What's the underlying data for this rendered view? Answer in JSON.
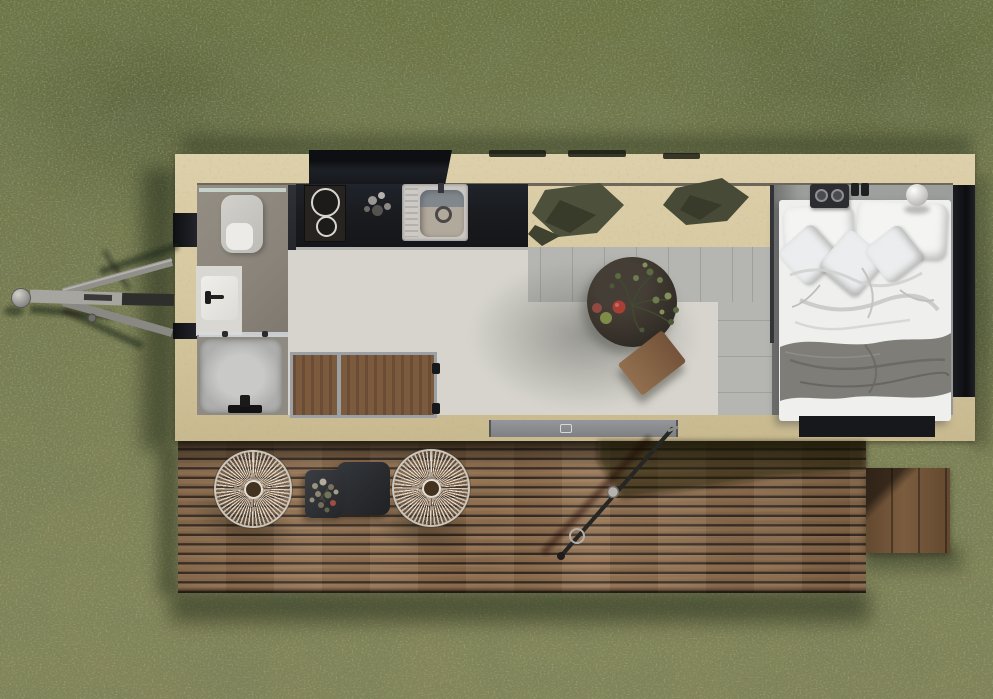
{
  "meta": {
    "description": "Aerial top-down 3D render of a tiny house on wheels standing on a grass lawn, with an attached hardwood terrace deck, tow hitch on the left and a small wooden step platform on the right",
    "view": "top-down aerial",
    "lighting": "daylight, sun from lower-left casting shadows up-right and down-left"
  },
  "palette": {
    "grass_base": "#76794f",
    "wood_frame": "#d6c8a0",
    "roof_black": "#15171b",
    "counter_black": "#1a1c20",
    "bath_floor": "#8a847b",
    "shower_tray": "#aeafad",
    "tile_gray": "#b5b6b2",
    "rug_light": "#d6d4cd",
    "bedroom_floor": "#a1a3a1",
    "bed_white": "#efefed",
    "blanket_gray": "#7f7d78",
    "table_dark": "#332d27",
    "stool_wood": "#8a6747",
    "deck_plank": "#9c7859",
    "deck_gap": "#33271d",
    "step_wood": "#7b5c3e",
    "chair_wicker": "#e8e4dc",
    "cushion_olive_a": "#4d503b",
    "cushion_olive_b": "#474a36",
    "cushion_fold": "#383b2a",
    "metal_gray": "#9a9894",
    "sill_gray": "#8f9196",
    "plant_green": "#5c6a42",
    "apple_red": "#a83e34",
    "apple_green": "#7e8c48"
  },
  "house": {
    "structure": [
      "light timber perimeter frame",
      "black roof opening above kitchen",
      "three dark roof vents along top edge",
      "black wall segments on left and right edges"
    ],
    "rooms": [
      {
        "name": "bathroom",
        "fixtures": [
          "toilet",
          "washbasin with black faucet",
          "glass-walled shower with black mixer"
        ]
      },
      {
        "name": "kitchen",
        "fixtures": [
          "black countertop",
          "two-burner cooktop",
          "stainless sink with drainboard",
          "small jars and bottles"
        ]
      },
      {
        "name": "living-area",
        "furniture": [
          "light rug floor",
          "gray tile border",
          "two olive floor cushions",
          "dark round coffee table",
          "plant sprigs with apples on table",
          "rotated wooden stool",
          "fold-down wall table with two wood panels and metal frame"
        ]
      },
      {
        "name": "bedroom",
        "furniture": [
          "double bed with white duvet",
          "two large pillows",
          "three small diamond pillows",
          "gray throw blanket",
          "black portable radio with two dials",
          "two black switches",
          "white sphere lamp",
          "dark under-bed step"
        ]
      }
    ],
    "exterior": [
      "gray entrance threshold in bottom frame",
      "A-frame tow hitch with ball coupling and drawbar"
    ]
  },
  "deck": {
    "material": "hardwood planks laid horizontally",
    "furniture": [
      "two round wicker lounge chairs with radial weave",
      "black square side table",
      "black tray with dried bouquet",
      "diagonal metal support pole with coupling",
      "side step platform of vertical planks"
    ],
    "shadows": [
      "house shadow band along top",
      "sun shadow wedge at right",
      "chair shadows",
      "pole shadow"
    ]
  },
  "environment": {
    "ground": "mottled mowed grass lawn, darker at top, lighter toward bottom",
    "shadows": [
      "soft house and deck shadows on grass"
    ]
  }
}
